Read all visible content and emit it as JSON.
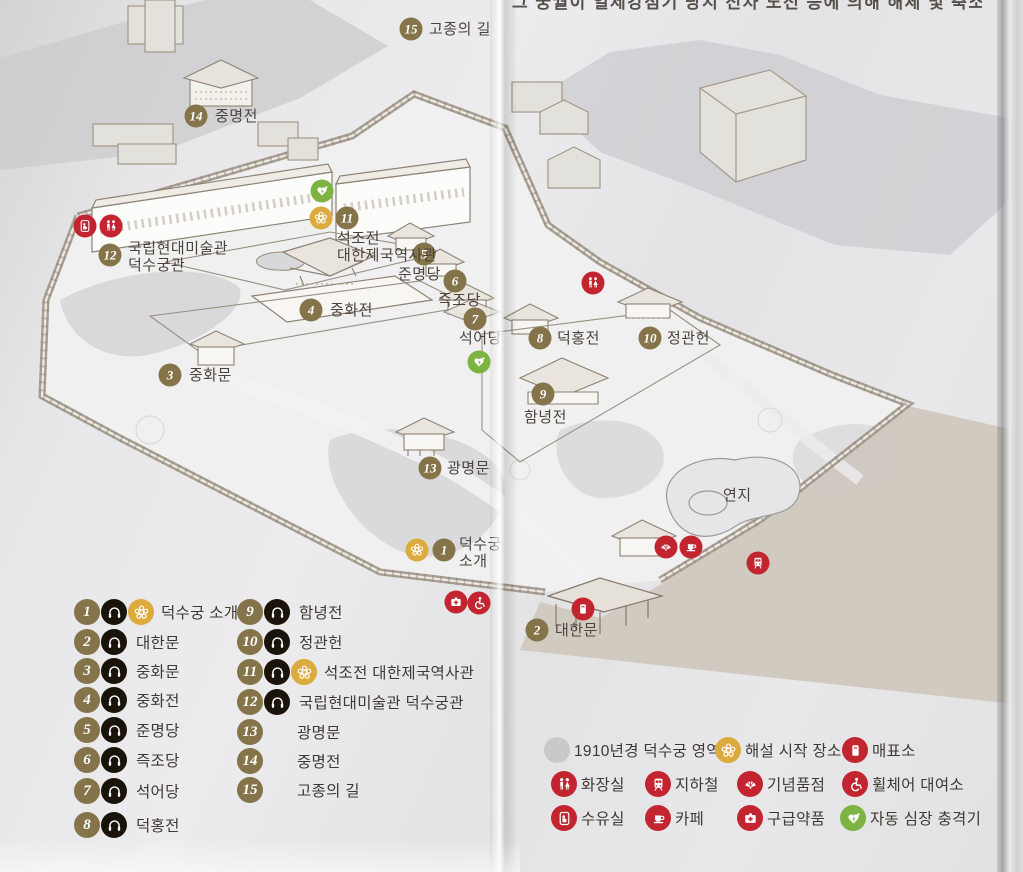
{
  "page": {
    "clipped_caption": "그 궁궐이 일제강점기 당시 전차 노선 등에 의해 해체 및 축소되었다.",
    "map_name": "덕수궁 안내도"
  },
  "colors": {
    "marker_olive": "#85744a",
    "audio_black": "#191309",
    "flower_gold": "#dcaa3d",
    "facility_red": "#c2252f",
    "aed_green": "#7cb342",
    "area_gray": "#c9c9cc",
    "label_text": "#4a443c"
  },
  "map": {
    "pond_label": "연지",
    "markers": [
      {
        "n": "1",
        "x": 444,
        "y": 550,
        "label_lines": [
          "덕수궁",
          "소개"
        ],
        "lx": 459,
        "ly": 536
      },
      {
        "n": "2",
        "x": 537,
        "y": 630,
        "label_lines": [
          "대한문"
        ],
        "lx": 555,
        "ly": 622
      },
      {
        "n": "3",
        "x": 170,
        "y": 375,
        "label_lines": [
          "중화문"
        ],
        "lx": 189,
        "ly": 367
      },
      {
        "n": "4",
        "x": 311,
        "y": 310,
        "label_lines": [
          "중화전"
        ],
        "lx": 330,
        "ly": 302
      },
      {
        "n": "5",
        "x": 424,
        "y": 254,
        "label_lines": [
          "준명당"
        ],
        "lx": 398,
        "ly": 266
      },
      {
        "n": "6",
        "x": 455,
        "y": 281,
        "label_lines": [
          "즉조당"
        ],
        "lx": 438,
        "ly": 292
      },
      {
        "n": "7",
        "x": 475,
        "y": 319,
        "label_lines": [
          "석어당"
        ],
        "lx": 459,
        "ly": 330
      },
      {
        "n": "8",
        "x": 540,
        "y": 338,
        "label_lines": [
          "덕홍전"
        ],
        "lx": 557,
        "ly": 330
      },
      {
        "n": "9",
        "x": 543,
        "y": 394,
        "label_lines": [
          "함녕전"
        ],
        "lx": 524,
        "ly": 409
      },
      {
        "n": "10",
        "x": 650,
        "y": 338,
        "label_lines": [
          "정관헌"
        ],
        "lx": 667,
        "ly": 330
      },
      {
        "n": "11",
        "x": 347,
        "y": 218,
        "label_lines": [
          "석조전",
          "대한제국역사관"
        ],
        "lx": 337,
        "ly": 230
      },
      {
        "n": "12",
        "x": 110,
        "y": 255,
        "label_lines": [
          "국립현대미술관",
          "덕수궁관"
        ],
        "lx": 128,
        "ly": 240
      },
      {
        "n": "13",
        "x": 430,
        "y": 468,
        "label_lines": [
          "광명문"
        ],
        "lx": 447,
        "ly": 460
      },
      {
        "n": "14",
        "x": 196,
        "y": 116,
        "label_lines": [
          "중명전"
        ],
        "lx": 215,
        "ly": 108
      },
      {
        "n": "15",
        "x": 411,
        "y": 29,
        "label_lines": [
          "고종의 길"
        ],
        "lx": 429,
        "ly": 21
      }
    ],
    "facilities": [
      {
        "icon": "nursing-room",
        "x": 85,
        "y": 226
      },
      {
        "icon": "toilet",
        "x": 111,
        "y": 226
      },
      {
        "icon": "aed",
        "x": 322,
        "y": 191
      },
      {
        "icon": "tour-start",
        "x": 321,
        "y": 218
      },
      {
        "icon": "tour-start",
        "x": 417,
        "y": 550
      },
      {
        "icon": "aed",
        "x": 479,
        "y": 362
      },
      {
        "icon": "toilet",
        "x": 593,
        "y": 283
      },
      {
        "icon": "souvenir",
        "x": 666,
        "y": 547
      },
      {
        "icon": "cafe",
        "x": 691,
        "y": 547
      },
      {
        "icon": "subway",
        "x": 758,
        "y": 563
      },
      {
        "icon": "ticket",
        "x": 583,
        "y": 609
      },
      {
        "icon": "first-aid",
        "x": 456,
        "y": 602
      },
      {
        "icon": "wheelchair",
        "x": 479,
        "y": 603
      }
    ]
  },
  "legend_sites": {
    "col1": [
      {
        "n": "1",
        "audio": true,
        "flower": true,
        "label": "덕수궁 소개",
        "y": 612
      },
      {
        "n": "2",
        "audio": true,
        "flower": false,
        "label": "대한문",
        "y": 642
      },
      {
        "n": "3",
        "audio": true,
        "flower": false,
        "label": "중화문",
        "y": 671
      },
      {
        "n": "4",
        "audio": true,
        "flower": false,
        "label": "중화전",
        "y": 700
      },
      {
        "n": "5",
        "audio": true,
        "flower": false,
        "label": "준명당",
        "y": 730
      },
      {
        "n": "6",
        "audio": true,
        "flower": false,
        "label": "즉조당",
        "y": 760
      },
      {
        "n": "7",
        "audio": true,
        "flower": false,
        "label": "석어당",
        "y": 791
      },
      {
        "n": "8",
        "audio": true,
        "flower": false,
        "label": "덕홍전",
        "y": 825
      }
    ],
    "col2": [
      {
        "n": "9",
        "audio": true,
        "flower": false,
        "label": "함녕전",
        "y": 612
      },
      {
        "n": "10",
        "audio": true,
        "flower": false,
        "label": "정관헌",
        "y": 642
      },
      {
        "n": "11",
        "audio": true,
        "flower": true,
        "label": "석조전 대한제국역사관",
        "y": 672
      },
      {
        "n": "12",
        "audio": true,
        "flower": false,
        "label": "국립현대미술관 덕수궁관",
        "y": 702
      },
      {
        "n": "13",
        "audio": false,
        "flower": false,
        "label": "광명문",
        "y": 732
      },
      {
        "n": "14",
        "audio": false,
        "flower": false,
        "label": "중명전",
        "y": 761
      },
      {
        "n": "15",
        "audio": false,
        "flower": false,
        "label": "고종의 길",
        "y": 790
      }
    ]
  },
  "legend_facilities": [
    {
      "icon": "area",
      "label": "1910년경 덕수궁 영역",
      "x": 557,
      "y": 750
    },
    {
      "icon": "tour-start",
      "label": "해설 시작 장소",
      "x": 728,
      "y": 750
    },
    {
      "icon": "ticket",
      "label": "매표소",
      "x": 855,
      "y": 750
    },
    {
      "icon": "toilet",
      "label": "화장실",
      "x": 564,
      "y": 784
    },
    {
      "icon": "subway",
      "label": "지하철",
      "x": 658,
      "y": 784
    },
    {
      "icon": "souvenir",
      "label": "기념품점",
      "x": 750,
      "y": 784
    },
    {
      "icon": "wheelchair",
      "label": "휠체어 대여소",
      "x": 855,
      "y": 784
    },
    {
      "icon": "nursing-room",
      "label": "수유실",
      "x": 564,
      "y": 818
    },
    {
      "icon": "cafe",
      "label": "카페",
      "x": 658,
      "y": 818
    },
    {
      "icon": "first-aid",
      "label": "구급약품",
      "x": 750,
      "y": 818
    },
    {
      "icon": "aed",
      "label": "자동 심장 충격기",
      "x": 853,
      "y": 818
    }
  ]
}
